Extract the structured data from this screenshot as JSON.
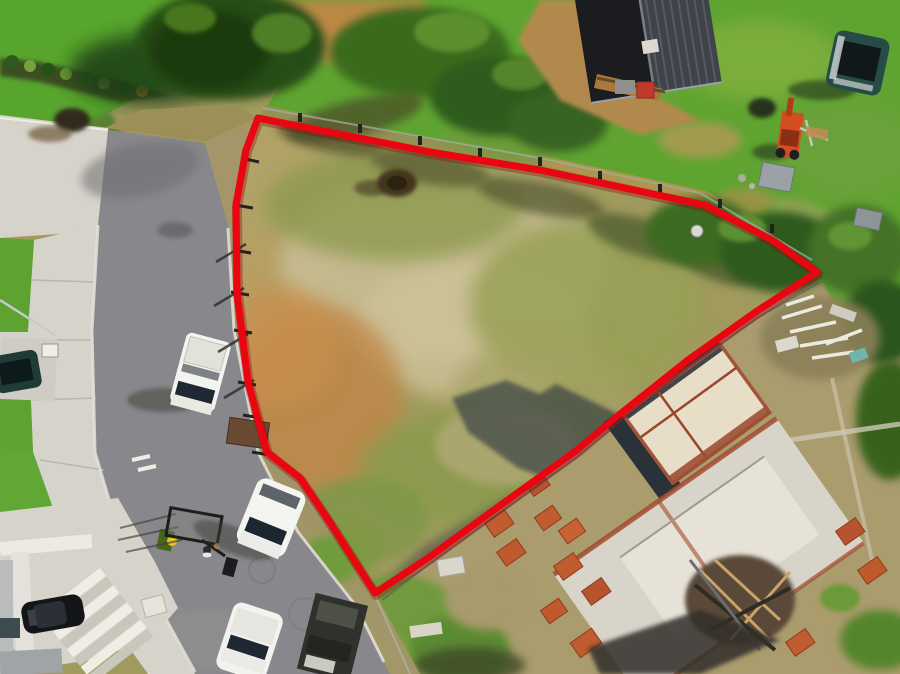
{
  "image_type": "aerial-drone-photograph",
  "scene": {
    "description": "Aerial drone view of a cleared vacant residential land lot outlined with a red property-boundary overlay, beside a curving suburban street with parked cars, a neighbouring house, lawns and an active construction site",
    "lot_surface": "patchy olive grass, tan sand and orange clay",
    "lighting": "bright daylight with long shadows cast toward lower-left"
  },
  "boundary": {
    "label": "lot-boundary-overlay",
    "stroke_color": "#ea0511",
    "shadow_color": "#8d040c",
    "stroke_width": 7,
    "points_str": "258,118 430,152 540,170 705,205 772,240 817,272 757,311 688,360 620,414 577,450 498,507 428,558 375,593 329,521 300,478 267,452 248,382 237,292 236,205 246,150 258,118"
  },
  "colors": {
    "lot_olive": "#a09a5e",
    "grass_green": "#5fa431",
    "lawn_dark": "#3f7a22",
    "lot_sand": "#c8bd94",
    "dirt_orange": "#c08747",
    "road_asphalt": "#88888c",
    "concrete": "#d6d3ca",
    "roof_dark": "#3f434a",
    "brick_orange": "#bf5c30",
    "shadow_blue": "#25323c",
    "dirt_tan": "#ab9c6e"
  },
  "objects": [
    {
      "name": "vacant-lot",
      "label": "cleared vacant lot inside red boundary"
    },
    {
      "name": "lot-boundary-line",
      "label": "red surveyed boundary outline"
    },
    {
      "name": "temporary-fencing",
      "label": "temporary mesh fencing along boundary"
    },
    {
      "name": "street",
      "label": "curving asphalt street"
    },
    {
      "name": "footpath",
      "label": "concrete footpath along street"
    },
    {
      "name": "top-left-lawn",
      "label": "lawn with large shade tree"
    },
    {
      "name": "neighbour-house-roof",
      "label": "dark tiled roof of neighbouring house"
    },
    {
      "name": "teal-suv",
      "label": "dark teal SUV parked on grass"
    },
    {
      "name": "tractor",
      "label": "orange compact tractor"
    },
    {
      "name": "white-ute",
      "label": "white ute parked on street"
    },
    {
      "name": "white-suv",
      "label": "white SUV parked on street"
    },
    {
      "name": "white-hatchback",
      "label": "white car at bottom edge"
    },
    {
      "name": "dark-truck",
      "label": "dark loaded truck"
    },
    {
      "name": "black-sedan",
      "label": "black sedan on driveway"
    },
    {
      "name": "teal-car-left",
      "label": "dark car on left driveway"
    },
    {
      "name": "box-trailer",
      "label": "box trailer on road"
    },
    {
      "name": "pedestrian",
      "label": "person walking with dog"
    },
    {
      "name": "wheelie-bin",
      "label": "green wheelie bin with yellow lid"
    },
    {
      "name": "skip-bin",
      "label": "brown skip bin"
    },
    {
      "name": "concrete-stairs",
      "label": "white concrete stairs"
    },
    {
      "name": "pergola-frame",
      "label": "white pergola frame of corner house"
    },
    {
      "name": "construction-site",
      "label": "house under construction with slab and brick walls"
    },
    {
      "name": "brick-pallets",
      "label": "pallets of orange bricks"
    },
    {
      "name": "timber-debris",
      "label": "pile of white timber debris"
    },
    {
      "name": "dirt-mound",
      "label": "dark mound of soil in lot"
    }
  ]
}
